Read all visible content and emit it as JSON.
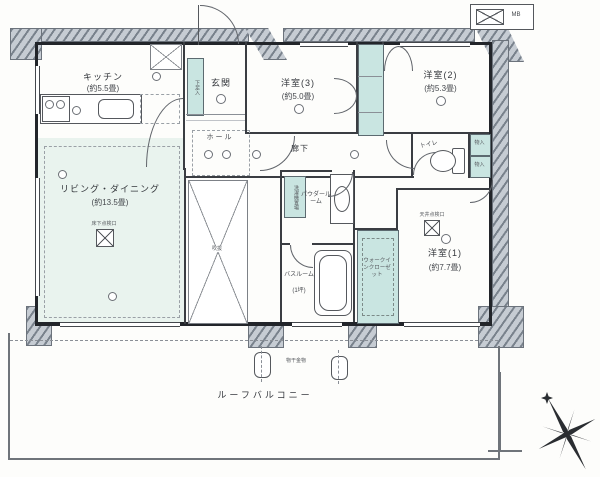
{
  "rooms": {
    "kitchen": {
      "label": "キッチン",
      "size": "(約5.5畳)"
    },
    "living": {
      "label": "リビング・ダイニング",
      "size": "(約13.5畳)"
    },
    "entrance": {
      "label": "玄関"
    },
    "hall": {
      "label": "ホール"
    },
    "western3": {
      "label": "洋室(3)",
      "size": "(約5.0畳)"
    },
    "western2": {
      "label": "洋室(2)",
      "size": "(約5.3畳)"
    },
    "western1": {
      "label": "洋室(1)",
      "size": "(約7.7畳)"
    },
    "toilet": {
      "label": "トイレ"
    },
    "corridor": {
      "label": "廊下"
    },
    "powder": {
      "label": "パウダールーム"
    },
    "bath": {
      "label": "バスルーム",
      "size": "(1坪)"
    },
    "wic": {
      "label": "ウォークインクローゼット"
    },
    "balcony": {
      "label": "ルーフバルコニー"
    },
    "void": {
      "label": "吹抜"
    }
  },
  "fixtures": {
    "meter_box": "MB",
    "shoe_box": "下足入",
    "storage_a": "物入",
    "storage_b": "物入",
    "washer": "洗濯機置場",
    "laundry_hook": "物干金物",
    "floor_hatch": "床下点検口",
    "ceiling_hatch": "天井点検口"
  },
  "colors": {
    "wall": "#22252a",
    "closet_fill": "#c9e5e1",
    "living_fill": "#e9f3ee",
    "pillar_fill": "#c6ccd3"
  }
}
